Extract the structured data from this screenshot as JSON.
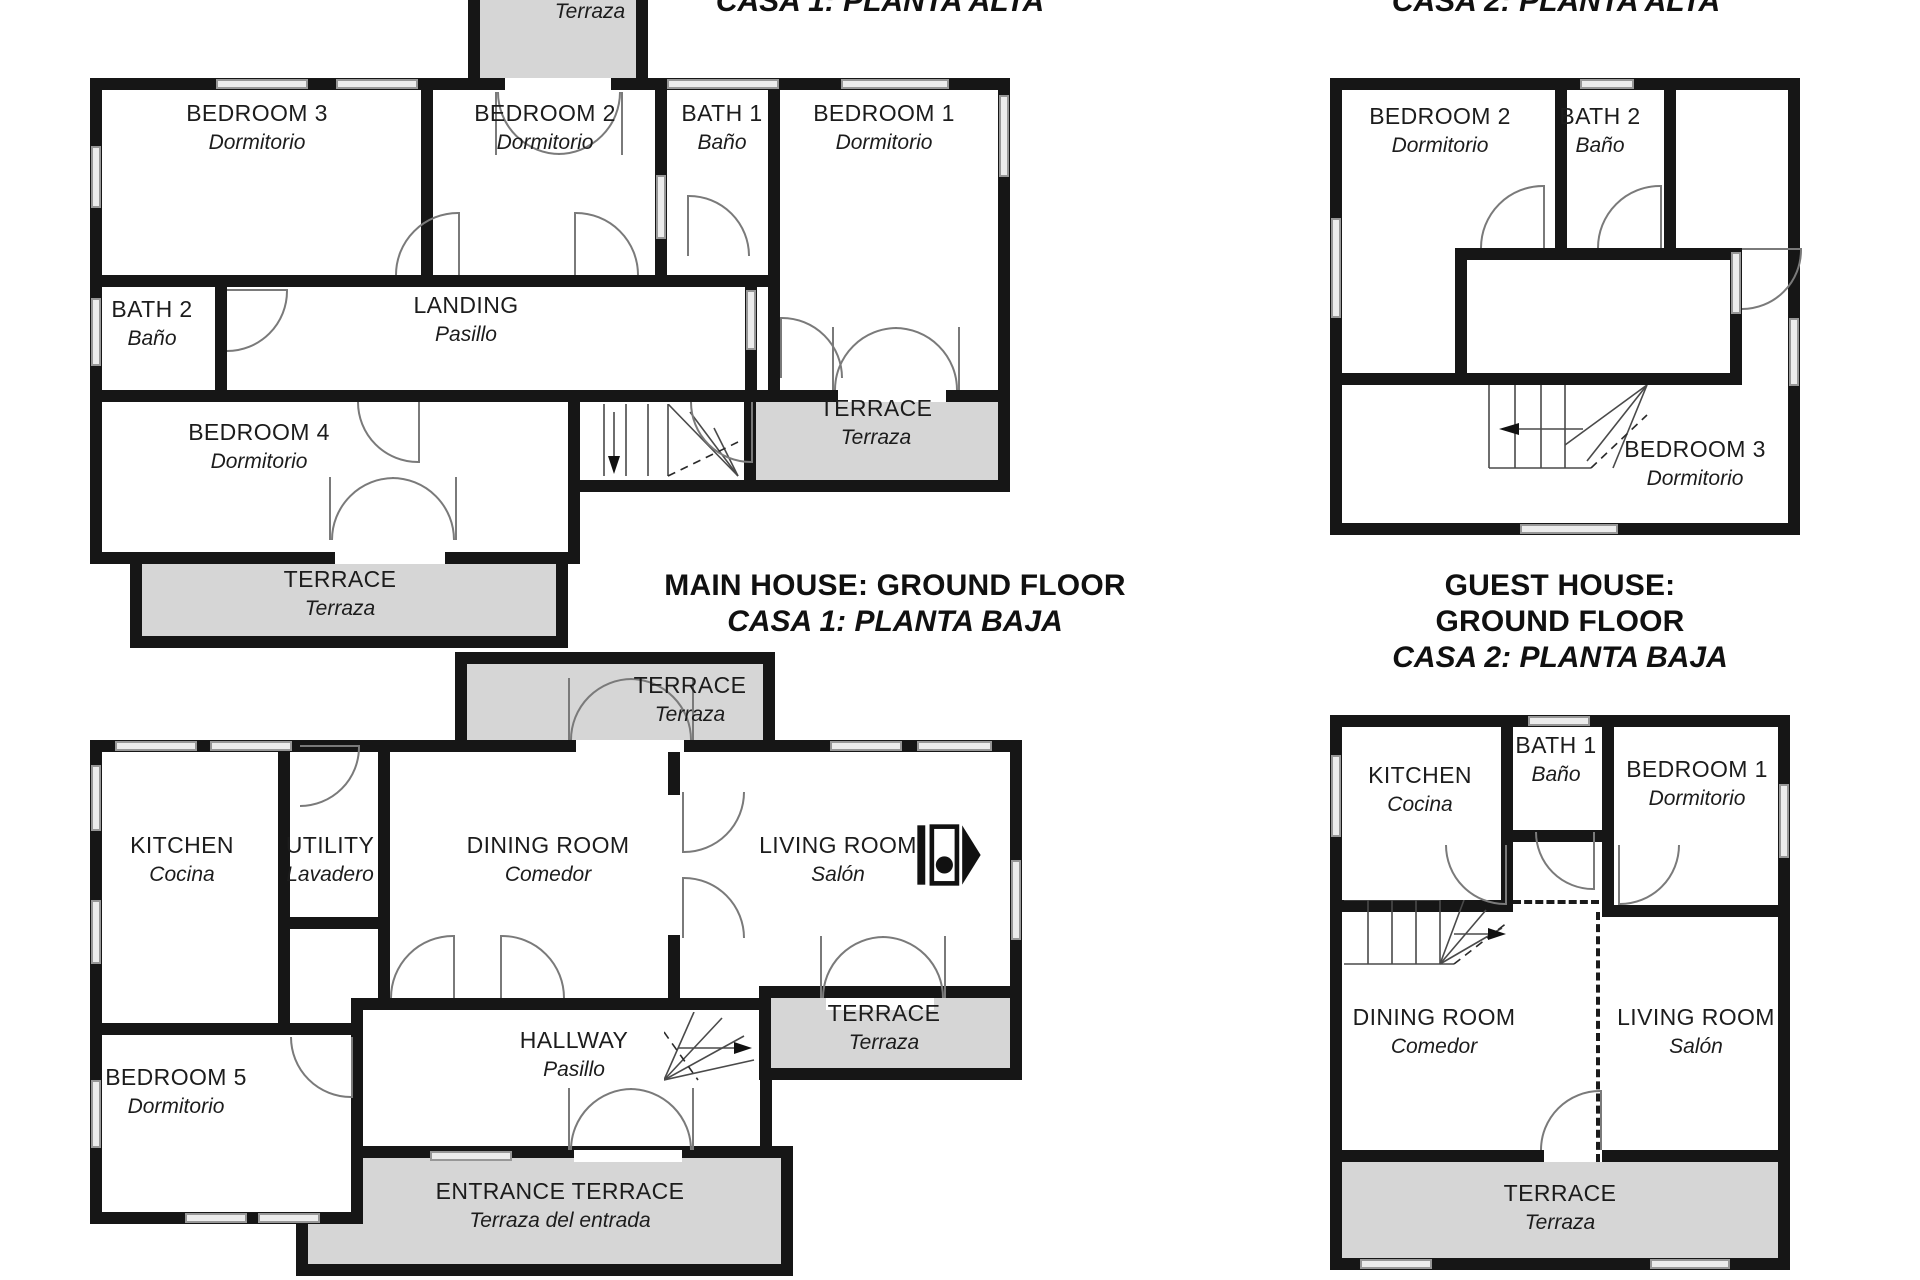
{
  "colors": {
    "wall": "#161616",
    "terrace_fill": "#d6d6d6",
    "door_line": "#7a7a7a",
    "window_fill": "#ececec"
  },
  "plans": {
    "main_upper": {
      "title_es": "CASA 1: PLANTA ALTA",
      "rooms": {
        "bedroom3": {
          "name": "BEDROOM 3",
          "sub": "Dormitorio"
        },
        "bedroom2": {
          "name": "BEDROOM 2",
          "sub": "Dormitorio"
        },
        "bath1": {
          "name": "BATH 1",
          "sub": "Baño"
        },
        "bedroom1": {
          "name": "BEDROOM 1",
          "sub": "Dormitorio"
        },
        "bath2": {
          "name": "BATH 2",
          "sub": "Baño"
        },
        "landing": {
          "name": "LANDING",
          "sub": "Pasillo"
        },
        "bedroom4": {
          "name": "BEDROOM 4",
          "sub": "Dormitorio"
        },
        "terrace_top": {
          "sub": "Terraza"
        },
        "terrace_right": {
          "name": "TERRACE",
          "sub": "Terraza"
        },
        "terrace_bottom": {
          "name": "TERRACE",
          "sub": "Terraza"
        }
      }
    },
    "guest_upper": {
      "title_es": "CASA 2: PLANTA ALTA",
      "rooms": {
        "bedroom2": {
          "name": "BEDROOM 2",
          "sub": "Dormitorio"
        },
        "bath2": {
          "name": "BATH 2",
          "sub": "Baño"
        },
        "bedroom3": {
          "name": "BEDROOM 3",
          "sub": "Dormitorio"
        }
      }
    },
    "main_ground": {
      "title_en": "MAIN HOUSE: GROUND FLOOR",
      "title_es": "CASA 1: PLANTA BAJA",
      "rooms": {
        "kitchen": {
          "name": "KITCHEN",
          "sub": "Cocina"
        },
        "utility": {
          "name": "UTILITY",
          "sub": "Lavadero"
        },
        "dining": {
          "name": "DINING ROOM",
          "sub": "Comedor"
        },
        "living": {
          "name": "LIVING ROOM",
          "sub": "Salón"
        },
        "hallway": {
          "name": "HALLWAY",
          "sub": "Pasillo"
        },
        "bedroom5": {
          "name": "BEDROOM 5",
          "sub": "Dormitorio"
        },
        "terrace_top": {
          "name": "TERRACE",
          "sub": "Terraza"
        },
        "terrace_right": {
          "name": "TERRACE",
          "sub": "Terraza"
        },
        "entrance_terrace": {
          "name": "ENTRANCE TERRACE",
          "sub": "Terraza del entrada"
        }
      }
    },
    "guest_ground": {
      "title_en": "GUEST HOUSE: GROUND FLOOR",
      "title_es": "CASA 2: PLANTA BAJA",
      "rooms": {
        "kitchen": {
          "name": "KITCHEN",
          "sub": "Cocina"
        },
        "bath1": {
          "name": "BATH 1",
          "sub": "Baño"
        },
        "bedroom1": {
          "name": "BEDROOM 1",
          "sub": "Dormitorio"
        },
        "dining": {
          "name": "DINING ROOM",
          "sub": "Comedor"
        },
        "living": {
          "name": "LIVING ROOM",
          "sub": "Salón"
        },
        "terrace": {
          "name": "TERRACE",
          "sub": "Terraza"
        }
      }
    }
  }
}
